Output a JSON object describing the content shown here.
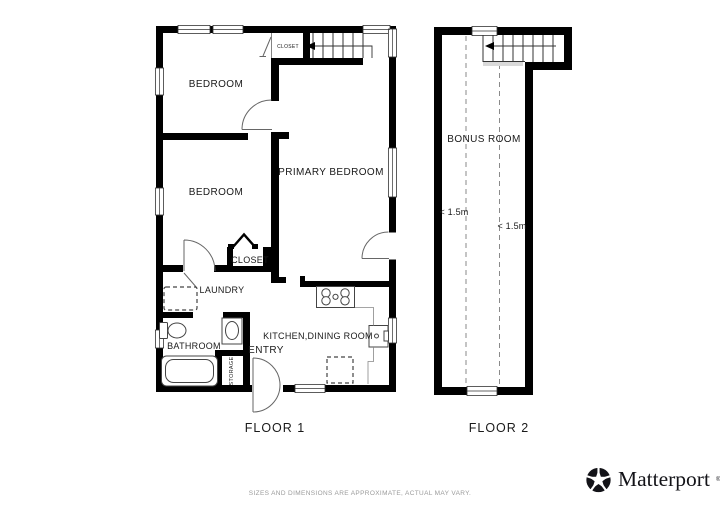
{
  "colors": {
    "wall": "#000000",
    "fixture_line": "#444444",
    "door_line": "#666666",
    "dashed_ceiling_line": "#8a8a8a",
    "label_text": "#1a1a1a",
    "muted_text": "#9b9b9b",
    "logo": "#131318"
  },
  "floor1": {
    "caption": "FLOOR 1",
    "rooms": {
      "bedroom_top": "BEDROOM",
      "bedroom_mid": "BEDROOM",
      "primary_bedroom": "PRIMARY BEDROOM",
      "closet_top": "CLOSET",
      "closet_mid": "CLOSET",
      "laundry": "LAUNDRY",
      "bathroom": "BATHROOM",
      "storage": "STORAGE",
      "entry": "ENTRY",
      "kitchen_dining": "KITCHEN,DINING ROOM"
    },
    "fixtures": [
      "stairs-up",
      "washer",
      "toilet",
      "bathroom-sink",
      "bathtub",
      "stove",
      "kitchen-sink",
      "dishwasher"
    ]
  },
  "floor2": {
    "caption": "FLOOR 2",
    "rooms": {
      "bonus_room": "BONUS ROOM"
    },
    "ceiling_notes": {
      "left": "< 1.5m",
      "right": "< 1.5m"
    },
    "fixtures": [
      "stairs-up"
    ]
  },
  "footer": {
    "disclaimer": "SIZES AND DIMENSIONS ARE APPROXIMATE, ACTUAL MAY VARY."
  },
  "branding": {
    "name": "Matterport",
    "mark": "®"
  }
}
